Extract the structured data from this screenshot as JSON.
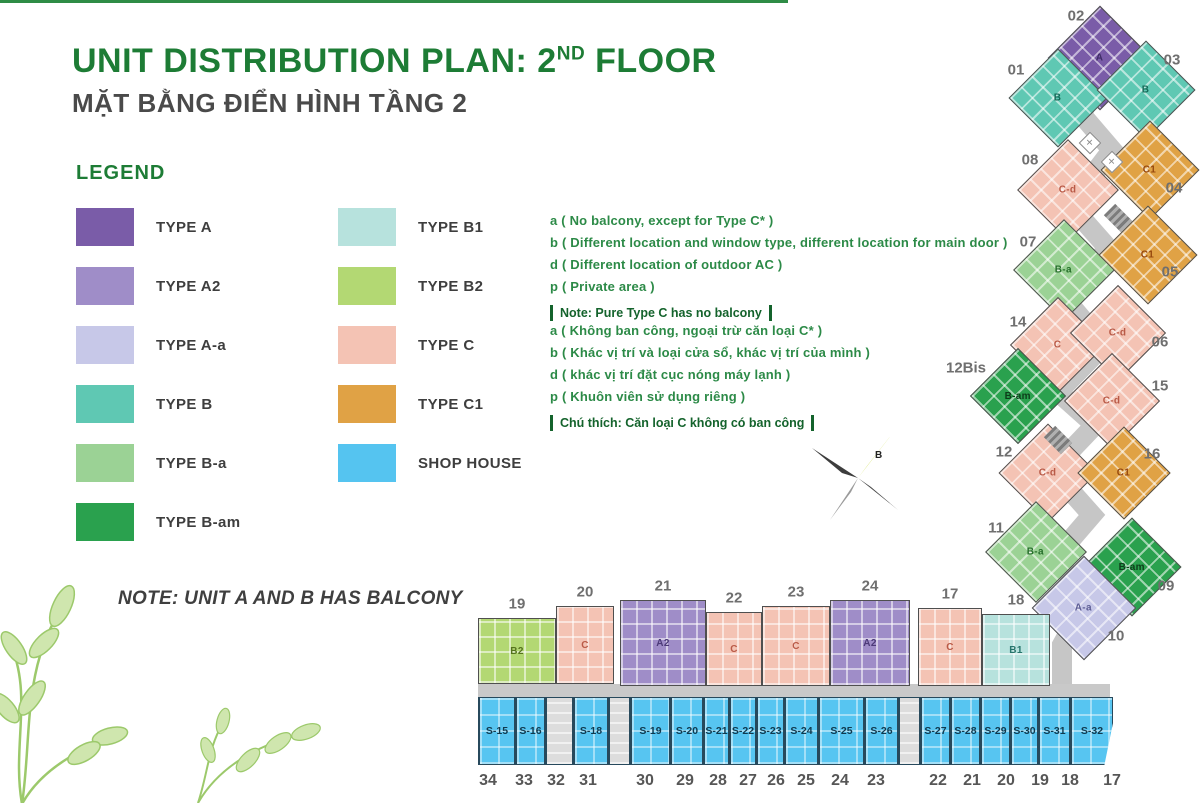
{
  "title": {
    "main": "UNIT DISTRIBUTION PLAN: 2",
    "sup": "ND",
    "tail": " FLOOR",
    "subtitle": "MẶT BẰNG ĐIỂN HÌNH TẦNG 2"
  },
  "legend": {
    "heading": "LEGEND",
    "columns": [
      [
        {
          "label": "TYPE A",
          "color": "#7a5ca8"
        },
        {
          "label": "TYPE A2",
          "color": "#9f8dc8"
        },
        {
          "label": "TYPE A-a",
          "color": "#c7c8e8"
        },
        {
          "label": "TYPE B",
          "color": "#5fc8b3"
        },
        {
          "label": "TYPE B-a",
          "color": "#9bd295"
        },
        {
          "label": "TYPE B-am",
          "color": "#2aa14e"
        }
      ],
      [
        {
          "label": "TYPE B1",
          "color": "#b7e2dd"
        },
        {
          "label": "TYPE B2",
          "color": "#b3d873"
        },
        {
          "label": "TYPE C",
          "color": "#f4c3b4"
        },
        {
          "label": "TYPE C1",
          "color": "#e0a245"
        },
        {
          "label": "SHOP HOUSE",
          "color": "#55c4f0"
        }
      ]
    ]
  },
  "notes_en": {
    "lines": [
      "a ( No balcony, except for Type C* )",
      "b ( Different location and window type, different location for main door )",
      "d ( Different location of outdoor AC )",
      "p ( Private area )"
    ],
    "boxed": "Note: Pure Type C has no balcony"
  },
  "notes_vi": {
    "lines": [
      "a ( Không ban công, ngoại trừ căn loại C* )",
      "b ( Khác vị trí và loại cửa sổ, khác vị trí của mình )",
      "d ( khác vị trí đặt cục nóng máy lạnh )",
      "p ( Khuôn viên sử dụng riêng )"
    ],
    "boxed": "Chú thích: Căn loại C không có ban công"
  },
  "balcony_note": "NOTE: UNIT A AND B HAS BALCONY",
  "compass": {
    "letter": "B"
  },
  "plan": {
    "type_colors": {
      "A": "#7a5ca8",
      "A2": "#9f8dc8",
      "A-a": "#c7c8e8",
      "B": "#5fc8b3",
      "B-a": "#9bd295",
      "B-am": "#2aa14e",
      "B1": "#b7e2dd",
      "B2": "#b3d873",
      "C": "#f4c3b4",
      "C-d": "#f4c3b4",
      "C1": "#e0a245"
    },
    "label_colors": {
      "A": "#3f2d66",
      "A2": "#4c3a78",
      "A-a": "#5d5d94",
      "B": "#156a58",
      "B-a": "#256e2a",
      "B-am": "#0d3d1a",
      "B1": "#27756c",
      "B2": "#55731c",
      "C": "#b95a47",
      "C-d": "#b95a47",
      "C1": "#96480e"
    },
    "chain": [
      {
        "no": "02",
        "type": "A",
        "cx": 1100,
        "cy": 58,
        "s": 74,
        "nx": 1076,
        "ny": 16
      },
      {
        "no": "01",
        "type": "B",
        "cx": 1058,
        "cy": 98,
        "s": 70,
        "nx": 1016,
        "ny": 70
      },
      {
        "no": "03",
        "type": "B",
        "cx": 1146,
        "cy": 90,
        "s": 70,
        "nx": 1172,
        "ny": 60
      },
      {
        "no": "08",
        "type": "C-d",
        "cx": 1068,
        "cy": 190,
        "s": 72,
        "nx": 1030,
        "ny": 160
      },
      {
        "no": "04",
        "type": "C1",
        "cx": 1150,
        "cy": 170,
        "s": 70,
        "nx": 1174,
        "ny": 188
      },
      {
        "no": "07",
        "type": "B-a",
        "cx": 1064,
        "cy": 270,
        "s": 72,
        "nx": 1028,
        "ny": 242
      },
      {
        "no": "05",
        "type": "C1",
        "cx": 1148,
        "cy": 255,
        "s": 70,
        "nx": 1170,
        "ny": 272
      },
      {
        "no": "14",
        "type": "C",
        "cx": 1058,
        "cy": 345,
        "s": 68,
        "nx": 1018,
        "ny": 322
      },
      {
        "no": "06",
        "type": "C-d",
        "cx": 1118,
        "cy": 333,
        "s": 68,
        "nx": 1160,
        "ny": 342
      },
      {
        "no": "12Bis",
        "type": "B-am",
        "cx": 1018,
        "cy": 396,
        "s": 68,
        "nx": 966,
        "ny": 368
      },
      {
        "no": "15",
        "type": "C-d",
        "cx": 1112,
        "cy": 401,
        "s": 68,
        "nx": 1160,
        "ny": 386
      },
      {
        "no": "12",
        "type": "C-d",
        "cx": 1048,
        "cy": 473,
        "s": 70,
        "nx": 1004,
        "ny": 452
      },
      {
        "no": "16",
        "type": "C1",
        "cx": 1124,
        "cy": 473,
        "s": 66,
        "nx": 1152,
        "ny": 454
      },
      {
        "no": "11",
        "type": "B-a",
        "cx": 1036,
        "cy": 552,
        "s": 72,
        "nx": 996,
        "ny": 528
      },
      {
        "no": "09",
        "type": "B-am",
        "cx": 1132,
        "cy": 567,
        "s": 70,
        "nx": 1166,
        "ny": 586
      },
      {
        "no": "10",
        "type": "A-a",
        "cx": 1084,
        "cy": 608,
        "s": 74,
        "nx": 1116,
        "ny": 636
      }
    ],
    "row": [
      {
        "no": "19",
        "type": "B2",
        "x": 478,
        "y": 618,
        "w": 78,
        "h": 66
      },
      {
        "no": "20",
        "type": "C",
        "x": 556,
        "y": 606,
        "w": 58,
        "h": 78
      },
      {
        "no": "21",
        "type": "A2",
        "x": 620,
        "y": 600,
        "w": 86,
        "h": 86
      },
      {
        "no": "22",
        "type": "C",
        "x": 706,
        "y": 612,
        "w": 56,
        "h": 74
      },
      {
        "no": "23",
        "type": "C",
        "x": 762,
        "y": 606,
        "w": 68,
        "h": 80
      },
      {
        "no": "24",
        "type": "A2",
        "x": 830,
        "y": 600,
        "w": 80,
        "h": 86
      },
      {
        "no": "17",
        "type": "C",
        "x": 918,
        "y": 608,
        "w": 64,
        "h": 78
      },
      {
        "no": "18",
        "type": "B1",
        "x": 982,
        "y": 614,
        "w": 68,
        "h": 72
      }
    ],
    "cores": [
      {
        "kind": "lift-icon",
        "x": 1090,
        "y": 143
      },
      {
        "kind": "lift-icon",
        "x": 1112,
        "y": 162
      },
      {
        "kind": "stair-icon",
        "x": 1118,
        "y": 218
      },
      {
        "kind": "stair-icon",
        "x": 1058,
        "y": 440
      }
    ],
    "shops": [
      {
        "label": "S-15",
        "w": 37
      },
      {
        "label": "S-16",
        "w": 30
      },
      {
        "label": "",
        "w": 28,
        "core": true
      },
      {
        "label": "S-18",
        "w": 35
      },
      {
        "label": "",
        "w": 22,
        "core": true
      },
      {
        "label": "S-19",
        "w": 40
      },
      {
        "label": "S-20",
        "w": 33
      },
      {
        "label": "S-21",
        "w": 26
      },
      {
        "label": "S-22",
        "w": 27
      },
      {
        "label": "S-23",
        "w": 28
      },
      {
        "label": "S-24",
        "w": 34
      },
      {
        "label": "S-25",
        "w": 46
      },
      {
        "label": "S-26",
        "w": 34
      },
      {
        "label": "",
        "w": 22,
        "core": true
      },
      {
        "label": "S-27",
        "w": 30
      },
      {
        "label": "S-28",
        "w": 30
      },
      {
        "label": "S-29",
        "w": 30
      },
      {
        "label": "S-30",
        "w": 28
      },
      {
        "label": "S-31",
        "w": 32
      },
      {
        "label": "S-32",
        "w": 43
      }
    ],
    "street_numbers": [
      {
        "n": "34",
        "x": 488
      },
      {
        "n": "33",
        "x": 524
      },
      {
        "n": "32",
        "x": 556
      },
      {
        "n": "31",
        "x": 588
      },
      {
        "n": "30",
        "x": 645
      },
      {
        "n": "29",
        "x": 685
      },
      {
        "n": "28",
        "x": 718
      },
      {
        "n": "27",
        "x": 748
      },
      {
        "n": "26",
        "x": 776
      },
      {
        "n": "25",
        "x": 806
      },
      {
        "n": "24",
        "x": 840
      },
      {
        "n": "23",
        "x": 876
      },
      {
        "n": "22",
        "x": 938
      },
      {
        "n": "21",
        "x": 972
      },
      {
        "n": "20",
        "x": 1006
      },
      {
        "n": "19",
        "x": 1040
      },
      {
        "n": "18",
        "x": 1070
      },
      {
        "n": "17",
        "x": 1112
      }
    ]
  }
}
